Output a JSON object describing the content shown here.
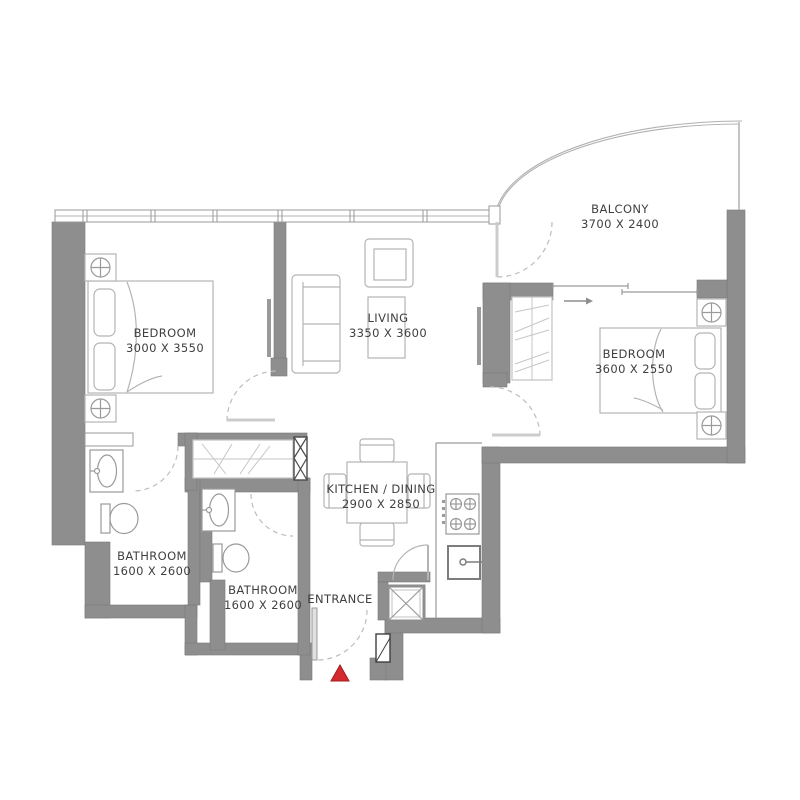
{
  "floor_plan": {
    "type": "apartment-floor-plan",
    "colors": {
      "background": "#ffffff",
      "wall": "#8e8e8e",
      "wall_edge": "#787878",
      "furniture_line": "#b4b4b4",
      "door_swing": "#bdbdbd",
      "text": "#3f3f3f",
      "entrance_marker": "#d42a2e"
    },
    "rooms": [
      {
        "id": "bedroom-1",
        "name": "BEDROOM",
        "dims": "3000 X 3550"
      },
      {
        "id": "living",
        "name": "LIVING",
        "dims": "3350 X 3600"
      },
      {
        "id": "balcony",
        "name": "BALCONY",
        "dims": "3700 X 2400"
      },
      {
        "id": "bedroom-2",
        "name": "BEDROOM",
        "dims": "3600 X 2550"
      },
      {
        "id": "bathroom-1",
        "name": "BATHROOM",
        "dims": "1600 X 2600"
      },
      {
        "id": "bathroom-2",
        "name": "BATHROOM",
        "dims": "1600 X 2600"
      },
      {
        "id": "kitchen-dining",
        "name": "KITCHEN / DINING",
        "dims": "2900 X 2850"
      },
      {
        "id": "entrance",
        "name": "ENTRANCE",
        "dims": ""
      }
    ]
  }
}
